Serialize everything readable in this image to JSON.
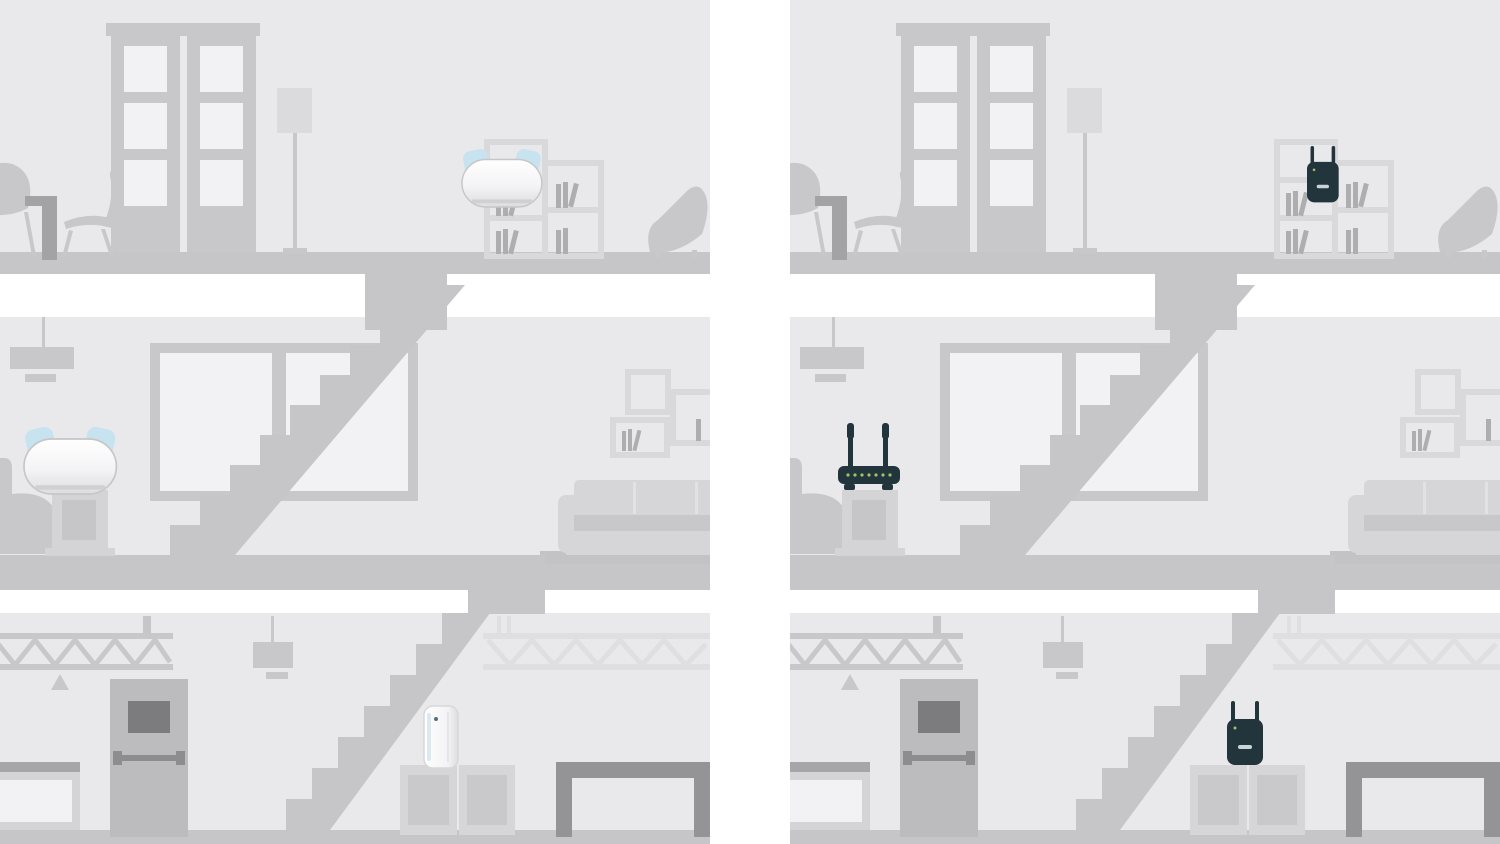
{
  "scene": {
    "type": "wifi-coverage-comparison-illustration",
    "panels": [
      {
        "id": "left",
        "solution": "mesh-wifi-system",
        "floors": 3,
        "devices": [
          {
            "type": "mesh-wifi-node",
            "style": "white-rounded-two-fins",
            "location": "top-floor-bookshelf"
          },
          {
            "type": "mesh-wifi-node",
            "style": "white-rounded-two-fins",
            "location": "middle-floor-side-table"
          },
          {
            "type": "mesh-wifi-node",
            "style": "white-tower",
            "location": "basement-crate"
          }
        ]
      },
      {
        "id": "right",
        "solution": "router-with-range-extenders",
        "floors": 3,
        "devices": [
          {
            "type": "range-extender",
            "style": "dark-wall-plug-two-antennas",
            "location": "top-floor-bookshelf"
          },
          {
            "type": "wireless-router",
            "style": "dark-body-two-antennas-led-row",
            "location": "middle-floor-side-table"
          },
          {
            "type": "range-extender",
            "style": "dark-wall-plug-two-antennas",
            "location": "basement-crates"
          }
        ]
      }
    ],
    "house": {
      "top_floor": [
        "shell-chair",
        "small-dark-table",
        "side-chair",
        "french-doors",
        "floor-lamp",
        "cube-bookshelf-with-books",
        "lounge-chair"
      ],
      "middle_floor": [
        "pendant-lamp",
        "wall-shelf",
        "armchair",
        "pedestal-side-table",
        "large-window",
        "staircase",
        "sofa-with-rug",
        "wall-box-shelves-with-books"
      ],
      "basement": [
        "steel-truss",
        "warning-triangle",
        "pendant-lamp",
        "metal-door-with-window-and-push-bar",
        "workbench",
        "storage-crates",
        "staircase",
        "metal-table"
      ]
    }
  },
  "colors": {
    "bg": "#ffffff",
    "wall": "#e9e9eb",
    "slab": "#c6c6c8",
    "furn": "#c8c8ca",
    "furn-light": "#d6d6d8",
    "furn-dark": "#9b9b9d",
    "pane": "#f2f2f4",
    "door": "#bcbcbe",
    "door-window": "#7c7c7e",
    "door-bar": "#8d8d8f",
    "lampshade": "#dbdbdd",
    "box-frame": "#d9d9db",
    "books": "#aeaeb0",
    "rug": "#c3c3c5",
    "truss-light": "#dfdfe1",
    "crate": "#d6d6d8",
    "crate-inner": "#c9c9cb",
    "pedestal": "#d4d4d6",
    "pedestal-inset": "#c6c6c8",
    "counter-top": "#a6a6a8",
    "table-dark": "#949496",
    "table-l": "#a3a3a5",
    "device-dark": "#22343c",
    "device-led": "#9cc368",
    "device-fin": "#c7e3ef",
    "device-edge": "#c6c6c8",
    "tower-accent": "#d2e6ee",
    "cushion-gap": "#e2e2e4"
  }
}
